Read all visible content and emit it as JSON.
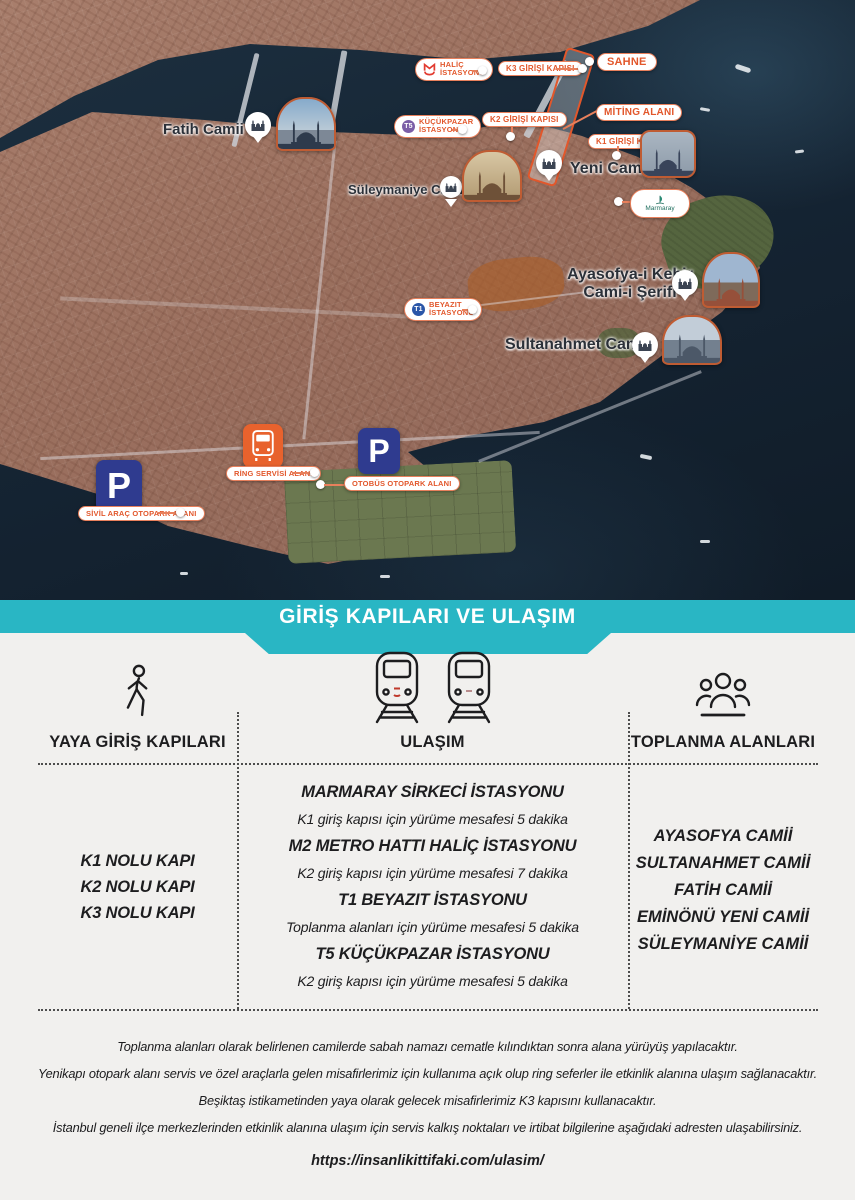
{
  "colors": {
    "teal": "#29b6c4",
    "orange": "#e2572b",
    "parking_navy": "#2f3b8f",
    "metro_red": "#e23b30",
    "t5_purple": "#7b5ea7",
    "t1_blue": "#2a56a8"
  },
  "map": {
    "stations": {
      "halic": {
        "line1": "HALİÇ",
        "line2": "İSTASYONU"
      },
      "kucukpazar": {
        "badge": "T5",
        "line1": "KÜÇÜKPAZAR",
        "line2": "İSTASYONU"
      },
      "beyazit": {
        "badge": "T1",
        "line1": "BEYAZIT",
        "line2": "İSTASYONU"
      }
    },
    "gates": {
      "k1": "K1 GİRİŞİ KAPISI",
      "k2": "K2 GİRİŞİ KAPISI",
      "k3": "K3 GİRİŞİ KAPISI"
    },
    "areas": {
      "sahne": "SAHNE",
      "miting": "MİTİNG ALANI",
      "ring": "RİNG SERVİSİ ALANI",
      "otobus": "OTOBÜS OTOPARK ALANI",
      "sivil": "SİVİL ARAÇ OTOPARK ALANI"
    },
    "places": {
      "fatih": "Fatih Camii",
      "suleymaniye": "Süleymaniye Camii",
      "yeni": "Yeni Camii",
      "marmaray": "Marmaray",
      "ayasofya1": "Ayasofya-i Kebir",
      "ayasofya2": "Cami-i Şerifi",
      "sultanahmet": "Sultanahmet Camii"
    },
    "parking_symbol": "P"
  },
  "banner": {
    "title": "GİRİŞ KAPILARI VE ULAŞIM"
  },
  "table": {
    "columns": [
      {
        "header": "YAYA GİRİŞ KAPILARI",
        "items": [
          "K1 NOLU KAPI",
          "K2 NOLU KAPI",
          "K3 NOLU KAPI"
        ]
      },
      {
        "header": "ULAŞIM",
        "entries": [
          {
            "station": "MARMARAY SİRKECİ İSTASYONU",
            "detail": "K1 giriş kapısı için yürüme mesafesi 5 dakika"
          },
          {
            "station": "M2 METRO HATTI HALİÇ İSTASYONU",
            "detail": "K2 giriş kapısı için yürüme mesafesi 7 dakika"
          },
          {
            "station": "T1 BEYAZIT İSTASYONU",
            "detail": "Toplanma alanları için yürüme mesafesi 5 dakika"
          },
          {
            "station": "T5 KÜÇÜKPAZAR İSTASYONU",
            "detail": "K2 giriş kapısı için yürüme mesafesi 5 dakika"
          }
        ]
      },
      {
        "header": "TOPLANMA ALANLARI",
        "items": [
          "AYASOFYA CAMİİ",
          "SULTANAHMET CAMİİ",
          "FATİH CAMİİ",
          "EMİNÖNÜ YENİ CAMİİ",
          "SÜLEYMANİYE CAMİİ"
        ]
      }
    ]
  },
  "notes": [
    "Toplanma alanları olarak belirlenen camilerde sabah namazı cematle kılındıktan sonra alana yürüyüş yapılacaktır.",
    "Yenikapı otopark alanı servis ve özel araçlarla gelen misafirlerimiz için kullanıma açık olup ring seferler ile etkinlik alanına ulaşım sağlanacaktır.",
    "Beşiktaş istikametinden yaya olarak gelecek misafirlerimiz K3 kapısını kullanacaktır.",
    "İstanbul geneli ilçe merkezlerinden etkinlik alanına ulaşım için servis kalkış noktaları ve irtibat bilgilerine aşağıdaki adresten ulaşabilirsiniz."
  ],
  "url": "https://insanlikittifaki.com/ulasim/"
}
